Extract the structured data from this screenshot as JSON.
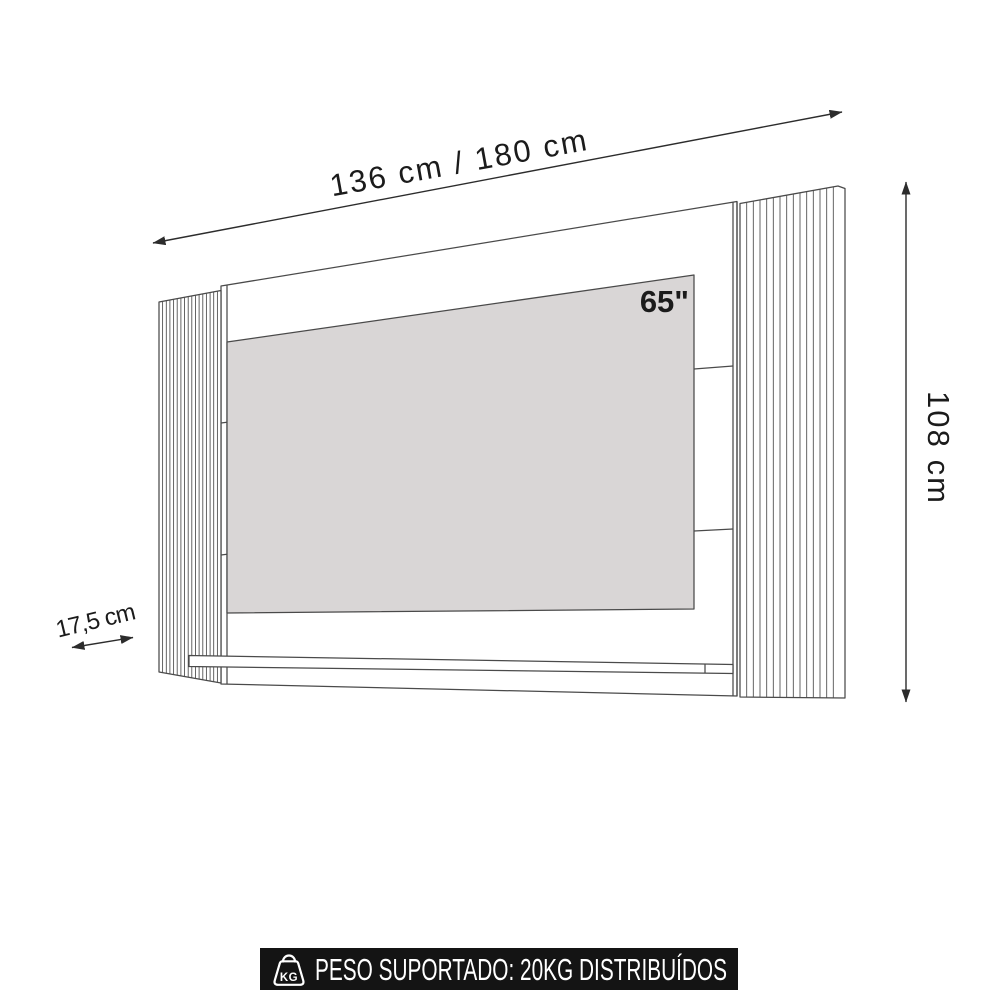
{
  "diagram": {
    "width_label": "136 cm / 180 cm",
    "height_label": "108 cm",
    "depth_label": "17,5 cm",
    "tv_size_label": "65\"",
    "slats": {
      "left_count": 16,
      "right_count": 14
    },
    "colors": {
      "line": "#4a4a4a",
      "dimension": "#2c2c2c",
      "text": "#1b1b1b",
      "tv_fill": "#d9d6d6",
      "banner_bg": "#141414",
      "banner_fg": "#ffffff",
      "background": "#ffffff"
    }
  },
  "banner": {
    "label": "PESO SUPORTADO: 20KG DISTRIBUÍDOS",
    "icon": "kg-weight-icon",
    "icon_label": "KG"
  }
}
